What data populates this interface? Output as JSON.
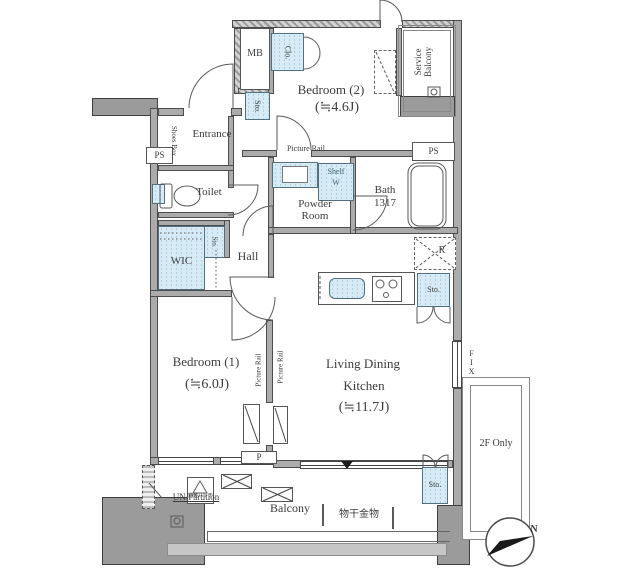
{
  "rooms": {
    "bedroom2": {
      "name": "Bedroom (2)",
      "area": "(≒4.6J)"
    },
    "bedroom1": {
      "name": "Bedroom (1)",
      "area": "(≒6.0J)"
    },
    "ldk": {
      "name_line1": "Living Dining",
      "name_line2": "Kitchen",
      "area": "(≒11.7J)"
    },
    "entrance": {
      "name": "Entrance"
    },
    "hall": {
      "name": "Hall"
    },
    "toilet": {
      "name": "Toilet"
    },
    "powder_room": {
      "name_line1": "Powder",
      "name_line2": "Room"
    },
    "bath": {
      "name": "Bath",
      "size": "1317"
    },
    "wic": {
      "name": "WIC"
    },
    "service_balcony": {
      "name_line1": "Service",
      "name_line2": "Balcony"
    },
    "balcony": {
      "name": "Balcony"
    },
    "area_2f_only": {
      "name": "2F Only"
    }
  },
  "fixtures": {
    "mb": "MB",
    "ps_left": "PS",
    "ps_right": "PS",
    "closet": "Clo.",
    "storage_entrance": "Sto.",
    "storage_hall": "Sto.",
    "storage_kitchen": "Sto.",
    "storage_balcony": "Sto.",
    "shoes_box": "Shoes Box",
    "shelf": "Shelf",
    "washer": "W",
    "refrigerator": "R",
    "fix_window": "FIX",
    "pipe": "P",
    "picture_rail_top": "Picture Rail",
    "picture_rail_left": "Picture Rail",
    "picture_rail_right": "Picture Rail",
    "un_partition": "UN/Partition",
    "laundry_hardware": "物干金物",
    "evacuation_hatch": "避難ハッチ"
  },
  "compass": {
    "north": "N"
  },
  "colors": {
    "wall": "#ababab",
    "pillar": "#9b9b9b",
    "fixture_blue": "#d7ebf7",
    "line": "#4c4c4c"
  }
}
